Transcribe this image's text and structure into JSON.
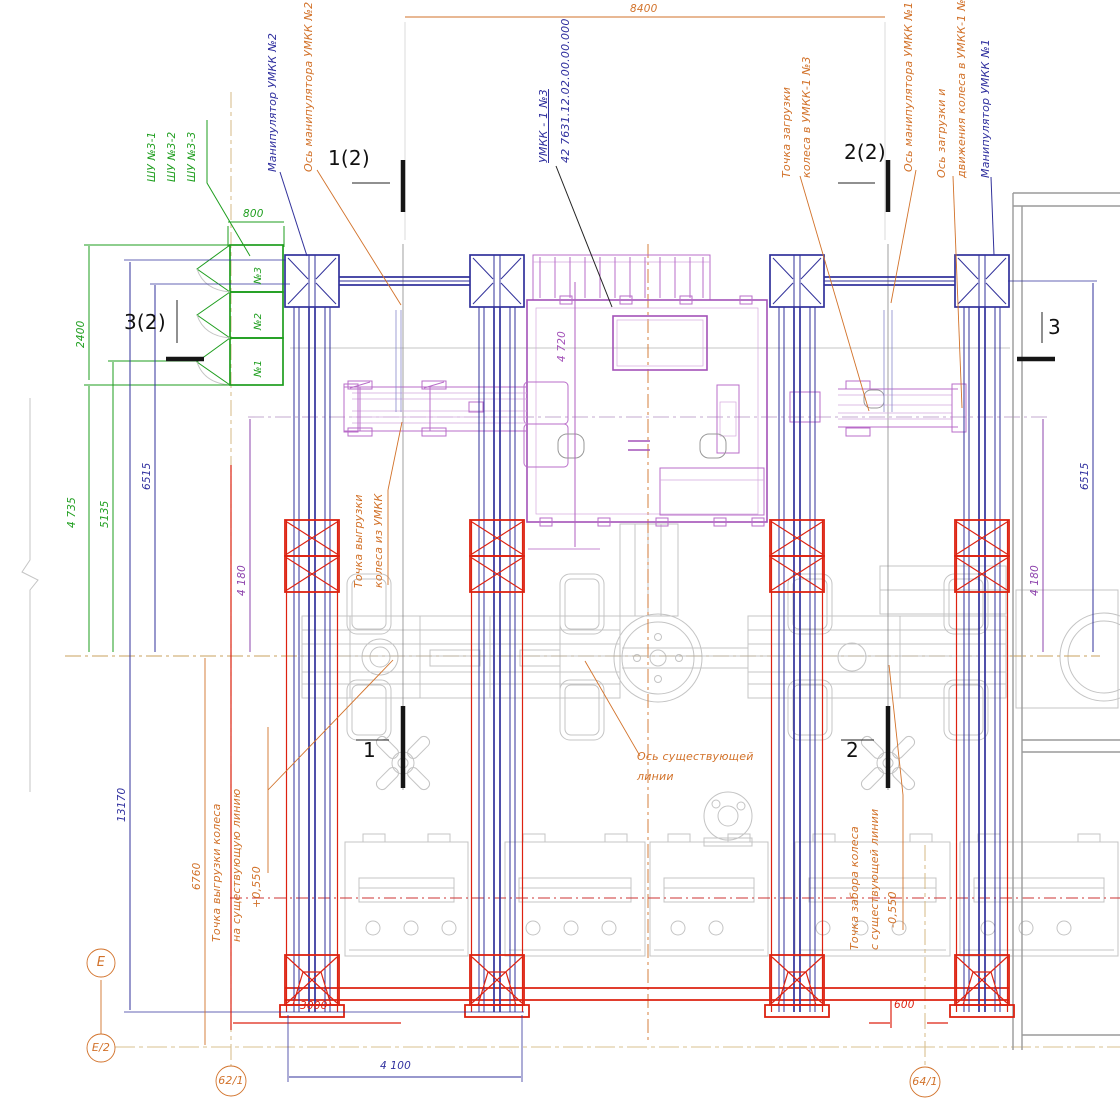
{
  "labels": {
    "shu1": "ШУ №3-1",
    "shu2": "ШУ №3-2",
    "shu3": "ШУ №3-3",
    "manip2": "Манипулятор УМКК №2",
    "axis_manip2": "Ось манипулятора УМКК №2",
    "umkk_name": "УМКК - 1 №3",
    "umkk_code": "42 7631.12.02.00.00.000",
    "load_point_l1": "Точка загрузки",
    "load_point_l2": "колеса в УМКК-1 №3",
    "axis_manip1": "Ось манипулятора УМКК №1",
    "axis_load_l1": "Ось загрузки и",
    "axis_load_l2": "движения колеса в УМКК-1 №3",
    "manip1": "Манипулятор УМКК №1",
    "unload_umkk_l1": "Точка выгрузки",
    "unload_umkk_l2": "колеса из УМКК",
    "axis_exist_l1": "Ось существующей",
    "axis_exist_l2": "линии",
    "unload_exist_l1": "Точка выгрузки колеса",
    "unload_exist_l2": "на существующую линию",
    "unload_exist_l3": "+0,550",
    "pickup_exist_l1": "Точка забора колеса",
    "pickup_exist_l2": "с существующей линии",
    "pickup_exist_l3": "-0,550",
    "cab3": "№3",
    "cab2": "№2",
    "cab1": "№1"
  },
  "dimensions": {
    "d8400": "8400",
    "d800": "800",
    "d2400": "2400",
    "d4735": "4 735",
    "d5135": "5135",
    "d6515_left": "6515",
    "d6515_right": "6515",
    "d4180_left": "4 180",
    "d4180_right": "4 180",
    "d4720": "4 720",
    "d13170": "13170",
    "d6760": "6760",
    "d3000": "3000",
    "d600": "600",
    "d4100": "4 100"
  },
  "sections": {
    "s12": "1(2)",
    "s22": "2(2)",
    "s32": "3(2)",
    "s3": "3",
    "s1": "1",
    "s2": "2"
  },
  "grid": {
    "e": "Е",
    "e2": "Е/2",
    "b21": "62/1",
    "b41": "64/1"
  },
  "colors": {
    "structure_blue": "#32329b",
    "foundation_red": "#dd2211",
    "cabinet_green": "#1e9e1e",
    "machine_magenta": "#a352b8",
    "leader_orange": "#d2722a",
    "grid_tan": "#d8c08f",
    "ghost_gray": "#c4c4c4",
    "wall_gray": "#9a9a9a",
    "section_black": "#151515"
  }
}
